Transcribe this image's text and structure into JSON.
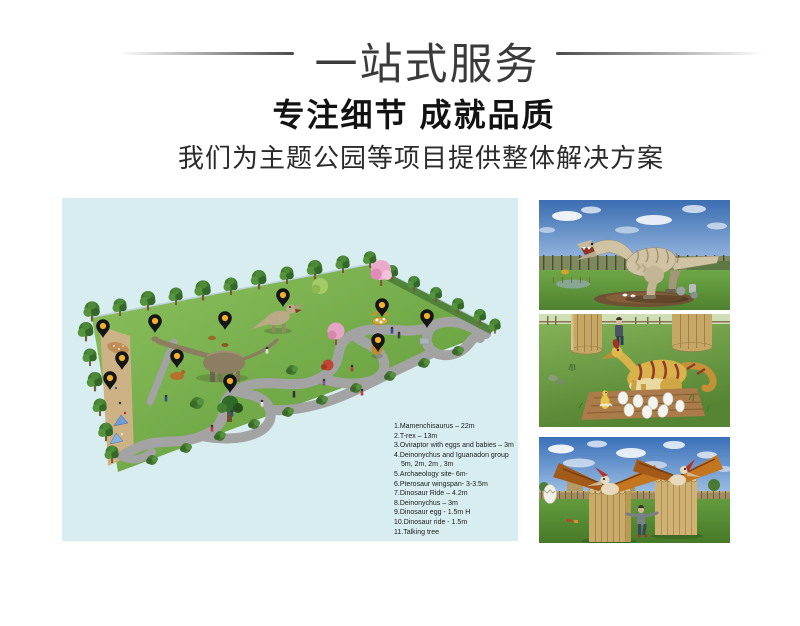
{
  "header": {
    "service_title": "一站式服务",
    "heading": "专注细节 成就品质",
    "subheading": "我们为主题公园等项目提供整体解决方案"
  },
  "map": {
    "background_color": "#d7edef",
    "pin_color": "#151515",
    "pin_dot_color": "#f2b02c",
    "pin_count": 11,
    "legend": [
      "1.Mamenchisaurus – 22m",
      "2.T-rex – 13m",
      "3.Oviraptor with eggs and babies – 3m",
      "4.Deinonychus and Iguanadon group",
      "5m, 2m, 2m , 3m",
      "5.Archaeology site- 6m-",
      "6.Pterosaur wingspan- 3-3.5m",
      "7.Dinosaur Ride – 4.2m",
      "8.Deinonychus – 3m",
      "9.Dinosaur egg - 1.5m H",
      "10.Dinosaur ride - 1.5m",
      "11.Talking tree"
    ]
  },
  "photos": [
    {
      "name": "t-rex-model"
    },
    {
      "name": "oviraptor-with-eggs-model"
    },
    {
      "name": "pterosaur-models"
    }
  ]
}
